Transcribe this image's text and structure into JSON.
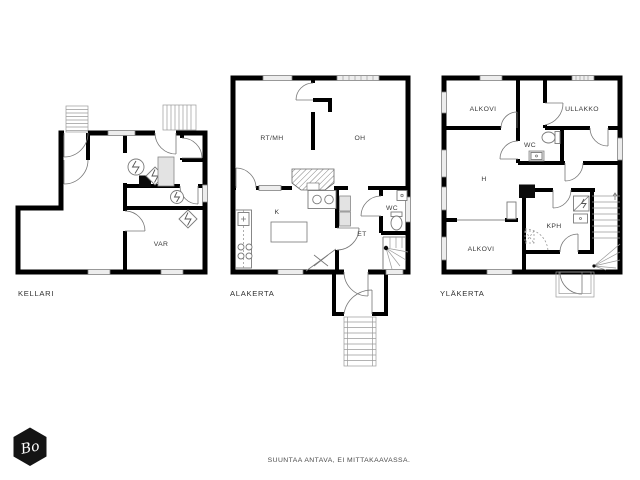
{
  "sheet": {
    "background": "#ffffff",
    "footer_note": "SUUNTAA ANTAVA, EI MITTAKAAVASSA.",
    "logo": {
      "text": "Bo",
      "shape": "hexagon",
      "fill": "#141414",
      "text_color": "#ffffff"
    },
    "colors": {
      "wall": "#000000",
      "detail_line": "#777777",
      "fixture_fill": "#e3e3e3",
      "window_fill": "#ededed",
      "label_text": "#3a3a3a"
    }
  },
  "plans": [
    {
      "id": "kellari",
      "title": "KELLARI",
      "rooms": [
        {
          "label": "VAR"
        }
      ],
      "symbols": [
        "exterior-stairs",
        "entry-doors",
        "washing-machine",
        "electric-boiler",
        "hot-water-tank",
        "water-heater",
        "electric-heater",
        "chimney",
        "windows"
      ]
    },
    {
      "id": "alakerta",
      "title": "ALAKERTA",
      "rooms": [
        {
          "label": "RT/MH"
        },
        {
          "label": "OH"
        },
        {
          "label": "K"
        },
        {
          "label": "ET"
        },
        {
          "label": "WC"
        }
      ],
      "symbols": [
        "fireplace",
        "kitchen-counter",
        "refrigerator",
        "stove",
        "double-sink",
        "dining-table",
        "toilet",
        "washbasin",
        "wardrobes",
        "winder-staircase",
        "entry-porch",
        "exterior-stairs",
        "windows"
      ]
    },
    {
      "id": "ylakerta",
      "title": "YLÄKERTA",
      "rooms": [
        {
          "label": "ALKOVI"
        },
        {
          "label": "ULLAKKO"
        },
        {
          "label": "WC"
        },
        {
          "label": "H"
        },
        {
          "label": "KPH"
        },
        {
          "label": "ALKOVI"
        }
      ],
      "symbols": [
        "toilet",
        "washbasin",
        "shower",
        "chimney",
        "staircase",
        "balcony",
        "windows"
      ]
    }
  ]
}
